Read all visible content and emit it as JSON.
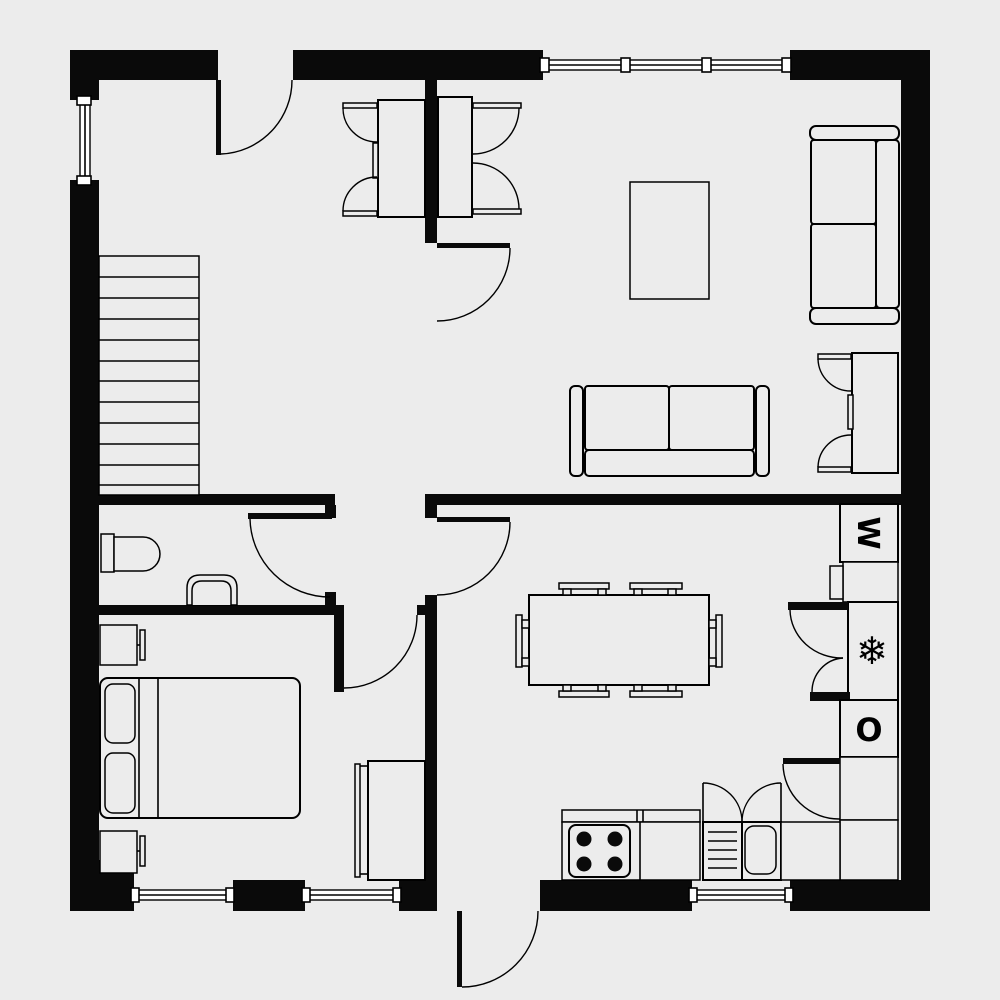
{
  "document": {
    "type": "residential floor plan",
    "colors": {
      "background": "#ececec",
      "walls": "#0a0a0a",
      "lines": "#000000",
      "window_fill": "#ffffff"
    }
  },
  "labels": {
    "washing_machine": "W",
    "freezer": "❄",
    "oven": "O"
  },
  "inventory": {
    "staircase_steps": 12,
    "stove_burners": 4,
    "dining_chairs": 6,
    "windows": 5,
    "door_swings": 9,
    "symbols": [
      "staircase",
      "entry-door",
      "interior-doors",
      "windows",
      "toilet",
      "washbasin",
      "double-bed",
      "nightstands",
      "wardrobe",
      "desks-with-chairs",
      "coffee-table",
      "two-seat-sofas",
      "reading-table-with-chairs",
      "dining-table",
      "kitchen-counter",
      "stove",
      "kitchen-sink",
      "washing-machine",
      "freezer",
      "oven"
    ]
  }
}
